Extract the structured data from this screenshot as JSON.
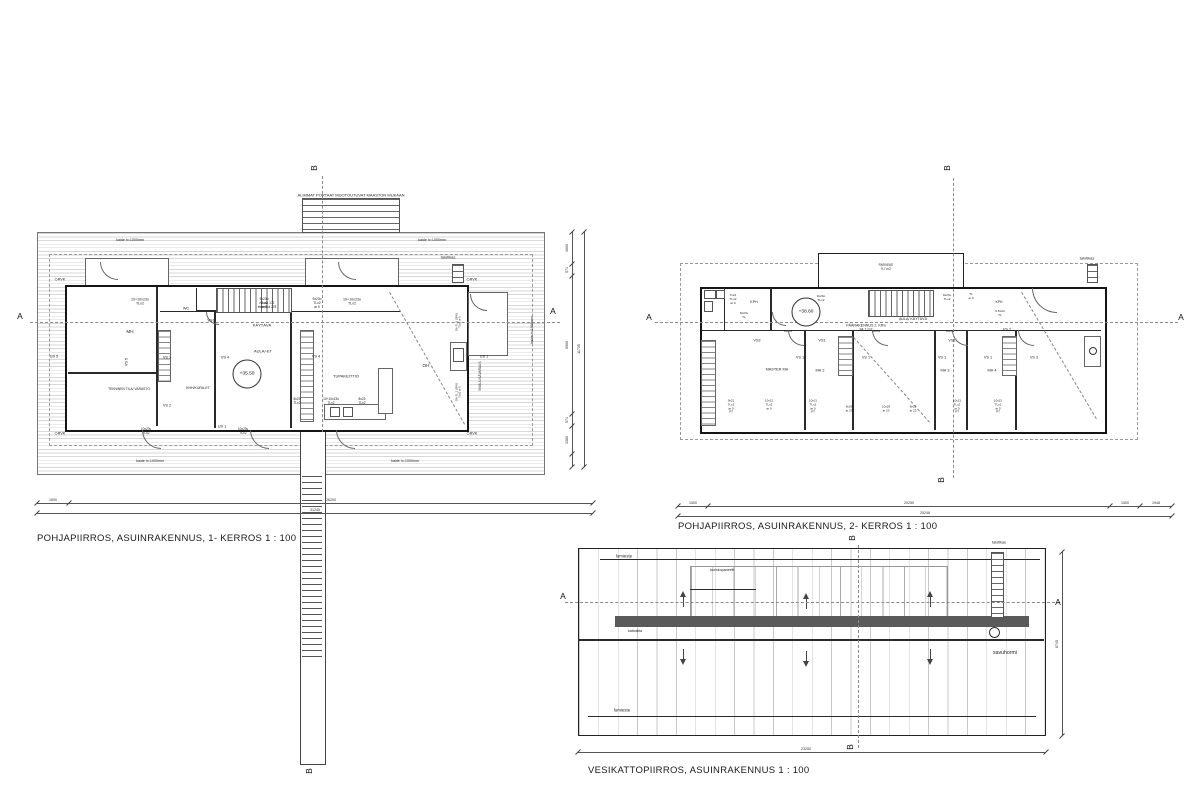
{
  "captions": {
    "plan1": "POHJAPIIRROS, ASUINRAKENNUS, 1- KERROS  1 : 100",
    "plan2": "POHJAPIIRROS, ASUINRAKENNUS, 2- KERROS  1 : 100",
    "roof": "VESIKATTOPIIRROS, ASUINRAKENNUS    1 : 100"
  },
  "levels": [
    {
      "t": "+35.50",
      "x": 247,
      "y": 374
    },
    {
      "t": "+38.60",
      "x": 806,
      "y": 312
    }
  ],
  "annotations": [
    {
      "t": "ALIMMAT PORTAAT MUOTOUTUVAT MAASTON MUKAAN",
      "x": 351,
      "y": 195,
      "fs": 4
    },
    {
      "t": "kaide h=1000mm",
      "x": 130,
      "y": 240,
      "fs": 3.6
    },
    {
      "t": "kaide h=1000mm",
      "x": 432,
      "y": 240,
      "fs": 3.6
    },
    {
      "t": "kaide h=1000mm",
      "x": 150,
      "y": 461,
      "fs": 3.6
    },
    {
      "t": "kaide h=1000mm",
      "x": 405,
      "y": 461,
      "fs": 3.6
    },
    {
      "t": "kaide h=1000mm",
      "x": 532,
      "y": 330,
      "fs": 3.6,
      "r": -90
    },
    {
      "t": "talotikas",
      "x": 448,
      "y": 257,
      "fs": 4
    },
    {
      "t": "◇RVK",
      "x": 60,
      "y": 280,
      "fs": 3.8
    },
    {
      "t": "◇RVK",
      "x": 472,
      "y": 280,
      "fs": 3.8
    },
    {
      "t": "◇RVK",
      "x": 60,
      "y": 434,
      "fs": 3.8
    },
    {
      "t": "◇RVK",
      "x": 472,
      "y": 434,
      "fs": 3.8
    },
    {
      "t": "10+10x23o\nTLx2",
      "x": 140,
      "y": 302,
      "fs": 3.6
    },
    {
      "t": "9x23o\nTLx2\nar 0",
      "x": 264,
      "y": 303,
      "fs": 3.3
    },
    {
      "t": "9x23o\nTLx2\nar 0",
      "x": 317,
      "y": 303,
      "fs": 3.3
    },
    {
      "t": "10+10x23o\nTLx2",
      "x": 352,
      "y": 302,
      "fs": 3.6
    },
    {
      "t": "WC",
      "x": 186,
      "y": 309,
      "fs": 3.8
    },
    {
      "t": "VS1",
      "x": 211,
      "y": 321,
      "fs": 3.8
    },
    {
      "t": "KÄYTÄVÄ",
      "x": 262,
      "y": 325,
      "fs": 4
    },
    {
      "t": "nousu 172\netenemä 278",
      "x": 267,
      "y": 305,
      "fs": 3.2
    },
    {
      "t": "MH",
      "x": 130,
      "y": 332,
      "fs": 4.6
    },
    {
      "t": "US 5",
      "x": 54,
      "y": 357,
      "fs": 3.8
    },
    {
      "t": "VS 5",
      "x": 127,
      "y": 362,
      "fs": 3.8,
      "r": -90
    },
    {
      "t": "VS 1",
      "x": 167,
      "y": 358,
      "fs": 3.8
    },
    {
      "t": "VS 4",
      "x": 225,
      "y": 358,
      "fs": 3.8
    },
    {
      "t": "VS 4",
      "x": 316,
      "y": 357,
      "fs": 3.8
    },
    {
      "t": "AULA/-ET",
      "x": 263,
      "y": 351,
      "fs": 4
    },
    {
      "t": "TEKNINEN TILA/ VARASTO",
      "x": 129,
      "y": 389,
      "fs": 3.3
    },
    {
      "t": "KHH/KURA-ET",
      "x": 198,
      "y": 388,
      "fs": 3.5
    },
    {
      "t": "VS 2",
      "x": 167,
      "y": 406,
      "fs": 3.8
    },
    {
      "t": "TUPAKEITTIÖ",
      "x": 346,
      "y": 376,
      "fs": 4
    },
    {
      "t": "OH",
      "x": 426,
      "y": 366,
      "fs": 4.6
    },
    {
      "t": "US 1",
      "x": 222,
      "y": 427,
      "fs": 3.8
    },
    {
      "t": "8x23\nTLx2",
      "x": 297,
      "y": 401,
      "fs": 3.2
    },
    {
      "t": "10+10x23o\nTLx2",
      "x": 331,
      "y": 401,
      "fs": 3.2
    },
    {
      "t": "8x23\nTLx2",
      "x": 362,
      "y": 401,
      "fs": 3.2
    },
    {
      "t": "10x23v\nTLx2",
      "x": 146,
      "y": 431,
      "fs": 3.2
    },
    {
      "t": "10x23v\nTLx2",
      "x": 243,
      "y": 431,
      "fs": 3.2
    },
    {
      "t": "US 1",
      "x": 484,
      "y": 357,
      "fs": 3.8
    },
    {
      "t": "INVA-/LISÄVARAUS",
      "x": 480,
      "y": 376,
      "fs": 3.2,
      "r": -90
    },
    {
      "t": "29+7L.1 (3PK)\nTLx2 ar 0",
      "x": 459,
      "y": 322,
      "fs": 2.8,
      "r": -90
    },
    {
      "t": "29+7L.1 (3PK)\nTLx2 ar 0",
      "x": 459,
      "y": 392,
      "fs": 2.8,
      "r": -90
    },
    {
      "t": "talotikas",
      "x": 1087,
      "y": 258,
      "fs": 4
    },
    {
      "t": "PARVEKE\n9,7 m2",
      "x": 886,
      "y": 267,
      "fs": 3.2
    },
    {
      "t": "7x21\nTLx2\nar 0",
      "x": 733,
      "y": 300,
      "fs": 3.1
    },
    {
      "t": "KPH",
      "x": 754,
      "y": 302,
      "fs": 3.6
    },
    {
      "t": "8x24v\nTL",
      "x": 744,
      "y": 316,
      "fs": 3.1
    },
    {
      "t": "9x23o\nTLx2",
      "x": 821,
      "y": 299,
      "fs": 3.1
    },
    {
      "t": "9x23v\nTLx2",
      "x": 947,
      "y": 298,
      "fs": 3.1
    },
    {
      "t": "TL\nar 0",
      "x": 971,
      "y": 297,
      "fs": 3.1
    },
    {
      "t": "KPH",
      "x": 999,
      "y": 302,
      "fs": 3.4
    },
    {
      "t": "6.5x24\nTL",
      "x": 1000,
      "y": 314,
      "fs": 3.1
    },
    {
      "t": "PÄÄRAKENNUS 2. KRS\n84,7 m2",
      "x": 866,
      "y": 328,
      "fs": 3.6
    },
    {
      "t": "AULA/ KÄYTÄVÄ",
      "x": 913,
      "y": 319,
      "fs": 3.6
    },
    {
      "t": "9x23v",
      "x": 788,
      "y": 332,
      "fs": 3.1
    },
    {
      "t": "9x23v",
      "x": 876,
      "y": 332,
      "fs": 3.1
    },
    {
      "t": "9x23v",
      "x": 950,
      "y": 332,
      "fs": 3.1
    },
    {
      "t": "VS2",
      "x": 757,
      "y": 341,
      "fs": 3.8
    },
    {
      "t": "VS1",
      "x": 822,
      "y": 341,
      "fs": 3.8
    },
    {
      "t": "VS1",
      "x": 952,
      "y": 341,
      "fs": 3.8
    },
    {
      "t": "VS 2",
      "x": 1007,
      "y": 330,
      "fs": 3.8
    },
    {
      "t": "VS 1",
      "x": 800,
      "y": 358,
      "fs": 3.8
    },
    {
      "t": "VS 1",
      "x": 866,
      "y": 358,
      "fs": 3.8
    },
    {
      "t": "VS 1",
      "x": 942,
      "y": 358,
      "fs": 3.8
    },
    {
      "t": "VS 1",
      "x": 988,
      "y": 358,
      "fs": 3.8
    },
    {
      "t": "VS 3",
      "x": 1034,
      "y": 358,
      "fs": 3.8
    },
    {
      "t": "MASTER MH",
      "x": 777,
      "y": 370,
      "fs": 3.8
    },
    {
      "t": "MH 2",
      "x": 820,
      "y": 371,
      "fs": 3.8
    },
    {
      "t": "MH 3",
      "x": 945,
      "y": 371,
      "fs": 3.8
    },
    {
      "t": "MH 4",
      "x": 992,
      "y": 371,
      "fs": 3.8
    },
    {
      "t": "9x21\nTLx2\nar 0\nPT",
      "x": 731,
      "y": 407,
      "fs": 3
    },
    {
      "t": "10x21\nTLx2\nar 0",
      "x": 769,
      "y": 405,
      "fs": 3
    },
    {
      "t": "10x21\nTLx2\nar 0\nPT",
      "x": 813,
      "y": 407,
      "fs": 3
    },
    {
      "t": "9x29\nar 23",
      "x": 849,
      "y": 409,
      "fs": 3
    },
    {
      "t": "10x29\nar 23",
      "x": 886,
      "y": 409,
      "fs": 3
    },
    {
      "t": "8x29\nar 23",
      "x": 913,
      "y": 409,
      "fs": 3
    },
    {
      "t": "10x21\nTLx2\nar 0\nPT",
      "x": 957,
      "y": 407,
      "fs": 3
    },
    {
      "t": "10x21\nTLx2\nar 0\nPT",
      "x": 998,
      "y": 407,
      "fs": 3
    },
    {
      "t": "lumieste",
      "x": 624,
      "y": 556,
      "fs": 4.4
    },
    {
      "t": "aurinkopaneelit",
      "x": 722,
      "y": 570,
      "fs": 3.6
    },
    {
      "t": "kattosilta",
      "x": 635,
      "y": 631,
      "fs": 3.6
    },
    {
      "t": "lumieste",
      "x": 622,
      "y": 710,
      "fs": 4.4
    },
    {
      "t": "talotikas",
      "x": 999,
      "y": 543,
      "fs": 3.8
    },
    {
      "t": "savuhormi",
      "x": 1005,
      "y": 653,
      "fs": 5.2
    }
  ],
  "section_markers": [
    {
      "t": "A",
      "x": 20,
      "y": 316
    },
    {
      "t": "A",
      "x": 553,
      "y": 311
    },
    {
      "t": "A",
      "x": 649,
      "y": 317
    },
    {
      "t": "A",
      "x": 1181,
      "y": 317
    },
    {
      "t": "A",
      "x": 563,
      "y": 596
    },
    {
      "t": "A",
      "x": 1058,
      "y": 602
    },
    {
      "t": "B",
      "x": 314,
      "y": 168,
      "r": -90
    },
    {
      "t": "B",
      "x": 309,
      "y": 771,
      "r": -90
    },
    {
      "t": "B",
      "x": 947,
      "y": 168,
      "r": -90
    },
    {
      "t": "B",
      "x": 941,
      "y": 480,
      "r": -90
    },
    {
      "t": "B",
      "x": 852,
      "y": 538,
      "r": -90
    },
    {
      "t": "B",
      "x": 850,
      "y": 747,
      "r": -90
    }
  ],
  "section_lines": [
    {
      "d": "h",
      "x": 30,
      "y": 322,
      "l": 530
    },
    {
      "d": "h",
      "x": 655,
      "y": 322,
      "l": 523
    },
    {
      "d": "h",
      "x": 565,
      "y": 602,
      "l": 495
    },
    {
      "d": "v",
      "x": 322,
      "y": 176,
      "l": 256
    },
    {
      "d": "v",
      "x": 953,
      "y": 178,
      "l": 300
    },
    {
      "d": "v",
      "x": 858,
      "y": 545,
      "l": 203
    }
  ],
  "dimensions": [
    {
      "d": "h",
      "x": 37,
      "y": 503,
      "l": 556,
      "ticks": [
        0,
        32,
        556
      ],
      "labels": [
        {
          "t": "1600",
          "o": 16
        },
        {
          "t": "26200",
          "o": 294
        }
      ]
    },
    {
      "d": "h",
      "x": 37,
      "y": 513,
      "l": 556,
      "ticks": [
        0,
        556
      ],
      "labels": [
        {
          "t": "31245",
          "o": 278
        }
      ]
    },
    {
      "d": "v",
      "x": 572,
      "y": 232,
      "l": 235,
      "ticks": [
        0,
        32,
        44,
        182,
        194,
        222,
        235
      ],
      "labels": [
        {
          "t": "1600",
          "o": 16
        },
        {
          "t": "574",
          "o": 38
        },
        {
          "t": "6900",
          "o": 113
        },
        {
          "t": "574",
          "o": 188
        },
        {
          "t": "1380",
          "o": 208
        }
      ]
    },
    {
      "d": "v",
      "x": 584,
      "y": 232,
      "l": 235,
      "ticks": [
        0,
        235
      ],
      "labels": [
        {
          "t": "11735",
          "o": 117
        }
      ]
    },
    {
      "d": "h",
      "x": 678,
      "y": 506,
      "l": 494,
      "ticks": [
        0,
        30,
        432,
        462,
        494
      ],
      "labels": [
        {
          "t": "1500",
          "o": 15
        },
        {
          "t": "20250",
          "o": 231
        },
        {
          "t": "1500",
          "o": 447
        },
        {
          "t": "1948",
          "o": 478
        }
      ]
    },
    {
      "d": "h",
      "x": 678,
      "y": 516,
      "l": 494,
      "ticks": [
        0,
        494
      ],
      "labels": [
        {
          "t": "25248",
          "o": 247
        }
      ]
    },
    {
      "d": "h",
      "x": 578,
      "y": 752,
      "l": 468,
      "ticks": [
        0,
        468
      ],
      "labels": [
        {
          "t": "23250",
          "o": 228
        }
      ]
    },
    {
      "d": "v",
      "x": 1062,
      "y": 552,
      "l": 184,
      "ticks": [
        0,
        184
      ],
      "labels": [
        {
          "t": "8745",
          "o": 92
        }
      ]
    }
  ],
  "colors": {
    "ink": "#151515",
    "line": "#555555",
    "hatch": "#d7d7d7",
    "band": "#5a5a5a",
    "background": "#ffffff"
  }
}
